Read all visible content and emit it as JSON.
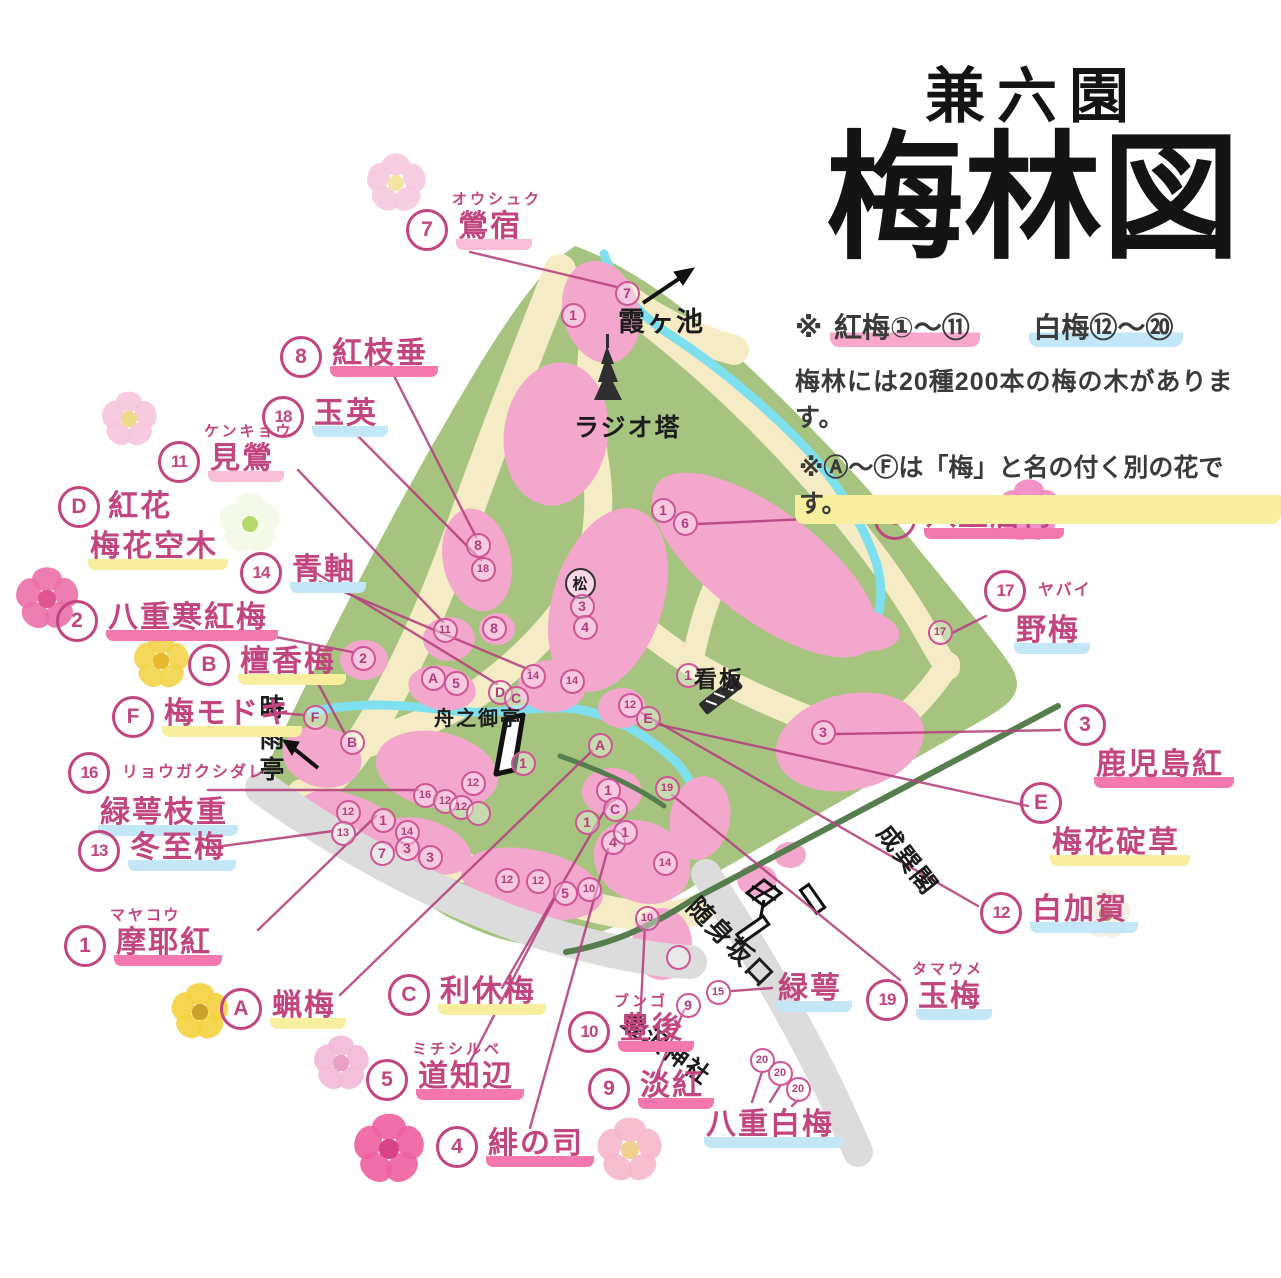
{
  "title": {
    "top": "兼六園",
    "main": "梅林図"
  },
  "legend": {
    "mark": "※",
    "red_label": "紅梅",
    "red_range": "①～⑪",
    "white_label": "白梅",
    "white_range": "⑫～⑳",
    "line2": "梅林には20種200本の梅の木があります。",
    "line3_pre": "※",
    "line3_badges": "Ⓐ～Ⓕ",
    "line3_rest": "は「梅」と名の付く別の花です。"
  },
  "colors": {
    "green": "#a6c47f",
    "path": "#f5ebc4",
    "pink_cluster": "#f3a7cd",
    "stream": "#7ee0ee",
    "road": "#dcdcdc",
    "boundary": "#567d4e",
    "ink": "#c2457f",
    "black_ink": "#1c1c1c",
    "hl_pink": "#f478ae",
    "hl_pink_light": "#f8bdd7",
    "hl_blue": "#c3e7f6",
    "hl_yellow": "#f8ef9e"
  },
  "labels": [
    {
      "name": "oushuku",
      "badge": "7",
      "kana": "オウシュク",
      "text": "鶯宿",
      "hl": "pinklight",
      "x": 406,
      "y": 192,
      "leader": [
        470,
        252,
        617,
        287
      ]
    },
    {
      "name": "beni-shidare",
      "badge": "8",
      "text": "紅枝垂",
      "hl": "pink",
      "x": 280,
      "y": 336,
      "leader": [
        390,
        368,
        476,
        537
      ]
    },
    {
      "name": "gyokuei",
      "badge": "18",
      "text": "玉英",
      "hl": "blue",
      "x": 262,
      "y": 396,
      "leader": [
        348,
        426,
        481,
        560
      ]
    },
    {
      "name": "kengyo",
      "badge": "11",
      "kana": "ケンキョウ",
      "text": "見鶯",
      "hl": "pinklight",
      "x": 158,
      "y": 424,
      "leader": [
        298,
        470,
        443,
        622
      ]
    },
    {
      "name": "benibana-baikautsugi",
      "badge": "D",
      "text": "紅花",
      "text2": "梅花空木",
      "hl": "yellow",
      "x": 58,
      "y": 486,
      "leader": [
        298,
        562,
        497,
        684
      ]
    },
    {
      "name": "aojiku",
      "badge": "14",
      "text": "青軸",
      "hl": "blue",
      "x": 240,
      "y": 552,
      "leader": [
        320,
        582,
        530,
        670
      ]
    },
    {
      "name": "yae-kanko-bai",
      "badge": "2",
      "text": "八重寒紅梅",
      "hl": "pink",
      "x": 56,
      "y": 600,
      "leader": [
        240,
        630,
        352,
        652
      ]
    },
    {
      "name": "danko-bai",
      "badge": "B",
      "text": "檀香梅",
      "hl": "yellow",
      "x": 188,
      "y": 644,
      "leader": [
        312,
        672,
        345,
        734
      ]
    },
    {
      "name": "ume-modoki",
      "badge": "F",
      "text": "梅モドキ",
      "hl": "yellow",
      "x": 112,
      "y": 696,
      "leader": [
        270,
        712,
        303,
        715
      ]
    },
    {
      "name": "ryokugaku-shidare",
      "badge": "16",
      "kana": "リョウガクシダレ",
      "text2": "緑萼枝重",
      "hl": "blue",
      "stack": true,
      "x": 68,
      "y": 752,
      "leader": [
        208,
        790,
        418,
        790
      ]
    },
    {
      "name": "toji-bai",
      "badge": "13",
      "text": "冬至梅",
      "hl": "blue",
      "x": 78,
      "y": 830,
      "leader": [
        208,
        848,
        333,
        831
      ]
    },
    {
      "name": "mayako",
      "badge": "1",
      "kana": "マヤコウ",
      "text": "摩耶紅",
      "hl": "pink",
      "x": 64,
      "y": 908,
      "leader": [
        258,
        930,
        376,
        816
      ]
    },
    {
      "name": "robai",
      "badge": "A",
      "text": "蝋梅",
      "hl": "yellow",
      "x": 220,
      "y": 988,
      "leader": [
        340,
        995,
        592,
        751
      ]
    },
    {
      "name": "rikyu-bai",
      "badge": "C",
      "text": "利休梅",
      "hl": "yellow",
      "x": 388,
      "y": 974,
      "leader": [
        502,
        988,
        610,
        801
      ]
    },
    {
      "name": "michishirube",
      "badge": "5",
      "kana": "ミチシルベ",
      "text": "道知辺",
      "hl": "pink",
      "x": 366,
      "y": 1042,
      "leader": [
        470,
        1062,
        560,
        888
      ]
    },
    {
      "name": "hi-no-tsukasa",
      "badge": "4",
      "text": "緋の司",
      "hl": "pink",
      "x": 436,
      "y": 1126,
      "leader": [
        530,
        1128,
        608,
        849
      ]
    },
    {
      "name": "bungo",
      "badge": "10",
      "kana": "ブンゴ",
      "text": "豊後",
      "hl": "pink",
      "x": 568,
      "y": 994,
      "leader": [
        640,
        1024,
        645,
        925
      ]
    },
    {
      "name": "tanko",
      "badge": "9",
      "text": "淡紅",
      "hl": "pink",
      "x": 588,
      "y": 1068,
      "leader": [
        654,
        1082,
        684,
        1010
      ]
    },
    {
      "name": "yae-hakubai",
      "text": "八重白梅",
      "hl": "blue",
      "x": 704,
      "y": 1108
    },
    {
      "name": "ryokugaku",
      "text": "緑萼",
      "hl": "blue",
      "x": 776,
      "y": 972,
      "leader": [
        732,
        991,
        772,
        988
      ]
    },
    {
      "name": "tama-ume",
      "badge": "19",
      "kana": "タマウメ",
      "text": "玉梅",
      "hl": "blue",
      "x": 866,
      "y": 962,
      "leader": [
        900,
        980,
        672,
        795
      ]
    },
    {
      "name": "shira-kaga",
      "badge": "12",
      "text": "白加賀",
      "hl": "blue",
      "x": 980,
      "y": 892,
      "leader": [
        978,
        906,
        640,
        712
      ]
    },
    {
      "name": "baika-ikariso",
      "badge": "E",
      "text2": "梅花碇草",
      "hl": "yellow",
      "stack": true,
      "x": 1020,
      "y": 782,
      "leader": [
        1028,
        806,
        656,
        724
      ]
    },
    {
      "name": "kagoshima-ko",
      "badge": "3",
      "text2": "鹿児島紅",
      "hl": "pink",
      "stack": true,
      "x": 1064,
      "y": 704,
      "leader": [
        1060,
        730,
        836,
        734
      ]
    },
    {
      "name": "yabai",
      "badge": "17",
      "kana": "ヤバイ",
      "text2": "野梅",
      "hl": "blue",
      "stack": true,
      "x": 984,
      "y": 570,
      "leader": [
        986,
        616,
        952,
        633
      ]
    },
    {
      "name": "yae-to-bai",
      "badge": "6",
      "text": "八重唐梅",
      "hl": "pink",
      "x": 874,
      "y": 498,
      "leader": [
        872,
        516,
        698,
        524
      ]
    }
  ],
  "extra_leaders": [
    [
      762,
      1072,
      752,
      1102
    ],
    [
      780,
      1086,
      770,
      1102
    ],
    [
      798,
      1100,
      792,
      1106
    ]
  ],
  "places": [
    {
      "name": "kasumigaike",
      "text": "霞ヶ池",
      "x": 618,
      "y": 300,
      "fs": 27
    },
    {
      "name": "radio-tower",
      "text": "ラジオ塔",
      "x": 574,
      "y": 408,
      "fs": 25
    },
    {
      "name": "kanban",
      "text": "看板",
      "x": 694,
      "y": 660,
      "fs": 23
    },
    {
      "name": "fune-no-otei",
      "text": "舟之御亭",
      "x": 434,
      "y": 702,
      "fs": 20
    },
    {
      "name": "shigure-tei",
      "text": "時雨亭",
      "x": 252,
      "y": 694,
      "fs": 25,
      "vertical": true
    },
    {
      "name": "seisonkaku",
      "text": "成巽閣",
      "x": 898,
      "y": 816,
      "fs": 25,
      "rot": 52
    },
    {
      "name": "zuishinzaka-guchi",
      "text": "随身坂口",
      "x": 706,
      "y": 888,
      "fs": 26,
      "rot": 46
    },
    {
      "name": "kanazawa-jinja",
      "text": "金沢神社",
      "x": 636,
      "y": 1002,
      "fs": 24,
      "rot": 36
    }
  ],
  "markers": [
    {
      "t": "7",
      "x": 627,
      "y": 293
    },
    {
      "t": "1",
      "x": 573,
      "y": 315
    },
    {
      "t": "8",
      "x": 478,
      "y": 545
    },
    {
      "t": "18",
      "x": 483,
      "y": 569
    },
    {
      "t": "11",
      "x": 445,
      "y": 630
    },
    {
      "t": "8",
      "x": 494,
      "y": 628
    },
    {
      "t": "2",
      "x": 363,
      "y": 658
    },
    {
      "t": "A",
      "x": 433,
      "y": 678
    },
    {
      "t": "5",
      "x": 456,
      "y": 683
    },
    {
      "t": "D",
      "x": 500,
      "y": 692
    },
    {
      "t": "C",
      "x": 516,
      "y": 698
    },
    {
      "t": "14",
      "x": 533,
      "y": 676
    },
    {
      "t": "14",
      "x": 572,
      "y": 681
    },
    {
      "t": "松",
      "x": 580,
      "y": 583,
      "black": true
    },
    {
      "t": "3",
      "x": 582,
      "y": 606
    },
    {
      "t": "4",
      "x": 585,
      "y": 627
    },
    {
      "t": "1",
      "x": 663,
      "y": 510
    },
    {
      "t": "6",
      "x": 685,
      "y": 523
    },
    {
      "t": "17",
      "x": 940,
      "y": 632
    },
    {
      "t": "1",
      "x": 688,
      "y": 675
    },
    {
      "t": "12",
      "x": 630,
      "y": 705
    },
    {
      "t": "E",
      "x": 648,
      "y": 718
    },
    {
      "t": "F",
      "x": 315,
      "y": 717
    },
    {
      "t": "B",
      "x": 352,
      "y": 742
    },
    {
      "t": "3",
      "x": 823,
      "y": 732
    },
    {
      "t": "A",
      "x": 600,
      "y": 745
    },
    {
      "t": "1",
      "x": 523,
      "y": 763
    },
    {
      "t": "12",
      "x": 473,
      "y": 783
    },
    {
      "t": "16",
      "x": 425,
      "y": 795
    },
    {
      "t": "12",
      "x": 445,
      "y": 801
    },
    {
      "t": "12",
      "x": 461,
      "y": 807
    },
    {
      "t": "",
      "x": 478,
      "y": 813
    },
    {
      "t": "12",
      "x": 348,
      "y": 812
    },
    {
      "t": "1",
      "x": 383,
      "y": 820
    },
    {
      "t": "13",
      "x": 343,
      "y": 833
    },
    {
      "t": "14",
      "x": 407,
      "y": 832
    },
    {
      "t": "7",
      "x": 382,
      "y": 853
    },
    {
      "t": "3",
      "x": 407,
      "y": 848
    },
    {
      "t": "3",
      "x": 430,
      "y": 857
    },
    {
      "t": "12",
      "x": 507,
      "y": 880
    },
    {
      "t": "12",
      "x": 538,
      "y": 881
    },
    {
      "t": "5",
      "x": 565,
      "y": 893
    },
    {
      "t": "10",
      "x": 589,
      "y": 889
    },
    {
      "t": "1",
      "x": 608,
      "y": 790
    },
    {
      "t": "C",
      "x": 615,
      "y": 809
    },
    {
      "t": "1",
      "x": 587,
      "y": 822
    },
    {
      "t": "4",
      "x": 613,
      "y": 842
    },
    {
      "t": "1",
      "x": 625,
      "y": 832
    },
    {
      "t": "19",
      "x": 667,
      "y": 788
    },
    {
      "t": "14",
      "x": 665,
      "y": 863
    },
    {
      "t": "10",
      "x": 647,
      "y": 918
    },
    {
      "t": "",
      "x": 678,
      "y": 957
    },
    {
      "t": "9",
      "x": 688,
      "y": 1005
    },
    {
      "t": "15",
      "x": 718,
      "y": 992
    },
    {
      "t": "20",
      "x": 762,
      "y": 1060
    },
    {
      "t": "20",
      "x": 780,
      "y": 1073
    },
    {
      "t": "20",
      "x": 798,
      "y": 1089
    }
  ],
  "flowers": [
    {
      "name": "light-pink-blossom",
      "x": 365,
      "y": 152,
      "s": 62,
      "c1": "#f6c8de",
      "c2": "#f3e6a0"
    },
    {
      "name": "pink-blossom",
      "x": 100,
      "y": 390,
      "s": 58,
      "c1": "#f6c4dc",
      "c2": "#f0d98a"
    },
    {
      "name": "white-green-flower",
      "x": 218,
      "y": 492,
      "s": 64,
      "c1": "#f3f8e8",
      "c2": "#b5d96a"
    },
    {
      "name": "deep-pink-rose",
      "x": 14,
      "y": 566,
      "s": 66,
      "c1": "#ec6fa8",
      "c2": "#e05592"
    },
    {
      "name": "yellow-flower",
      "x": 132,
      "y": 632,
      "s": 58,
      "c1": "#f2d44a",
      "c2": "#e8b92e"
    },
    {
      "name": "robai-yellow-flower",
      "x": 170,
      "y": 982,
      "s": 60,
      "c1": "#f5d23e",
      "c2": "#caa22a"
    },
    {
      "name": "pale-pink-blossom",
      "x": 312,
      "y": 1034,
      "s": 58,
      "c1": "#f3b8d6",
      "c2": "#eba0c6"
    },
    {
      "name": "deep-pink-blossom",
      "x": 352,
      "y": 1112,
      "s": 74,
      "c1": "#ee5f9e",
      "c2": "#d94387"
    },
    {
      "name": "salmon-blossom",
      "x": 596,
      "y": 1116,
      "s": 68,
      "c1": "#f6b7cb",
      "c2": "#f0cf8e"
    },
    {
      "name": "lotus-pink-flower",
      "x": 996,
      "y": 478,
      "s": 66,
      "c1": "#ef87c0",
      "c2": "#f3d34e"
    },
    {
      "name": "white-cotton-flower",
      "x": 1080,
      "y": 888,
      "s": 52,
      "c1": "#f3ece2",
      "c2": "#b9906d"
    }
  ]
}
